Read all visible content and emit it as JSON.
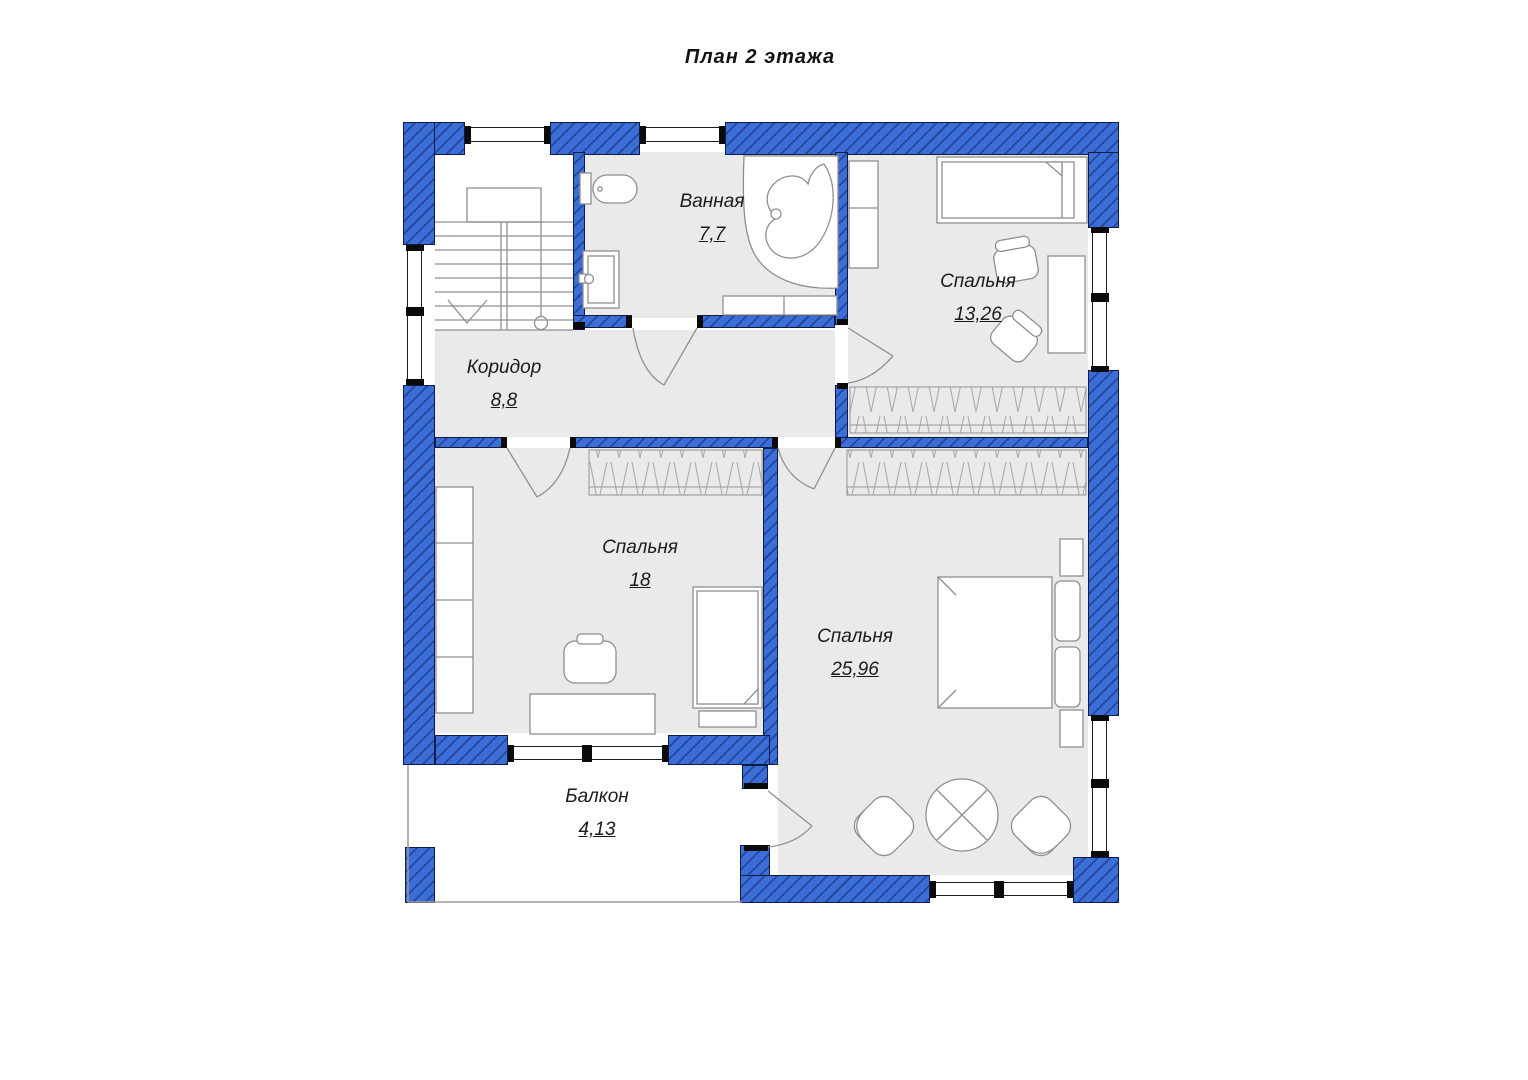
{
  "title": "План 2 этажа",
  "rooms": [
    {
      "id": "bathroom",
      "name": "Ванная",
      "area": "7,7"
    },
    {
      "id": "bedroom-small",
      "name": "Спальня",
      "area": "13,26"
    },
    {
      "id": "corridor",
      "name": "Коридор",
      "area": "8,8"
    },
    {
      "id": "bedroom-left",
      "name": "Спальня",
      "area": "18"
    },
    {
      "id": "bedroom-master",
      "name": "Спальня",
      "area": "25,96"
    },
    {
      "id": "balcony",
      "name": "Балкон",
      "area": "4,13"
    }
  ],
  "colors": {
    "wall_fill": "#3c6ed8",
    "wall_hatch": "#102669",
    "wall_outline": "#0e1b45",
    "floor": "#eaeaea",
    "furniture_line": "#8f8f8f",
    "text": "#1b1b1b"
  }
}
